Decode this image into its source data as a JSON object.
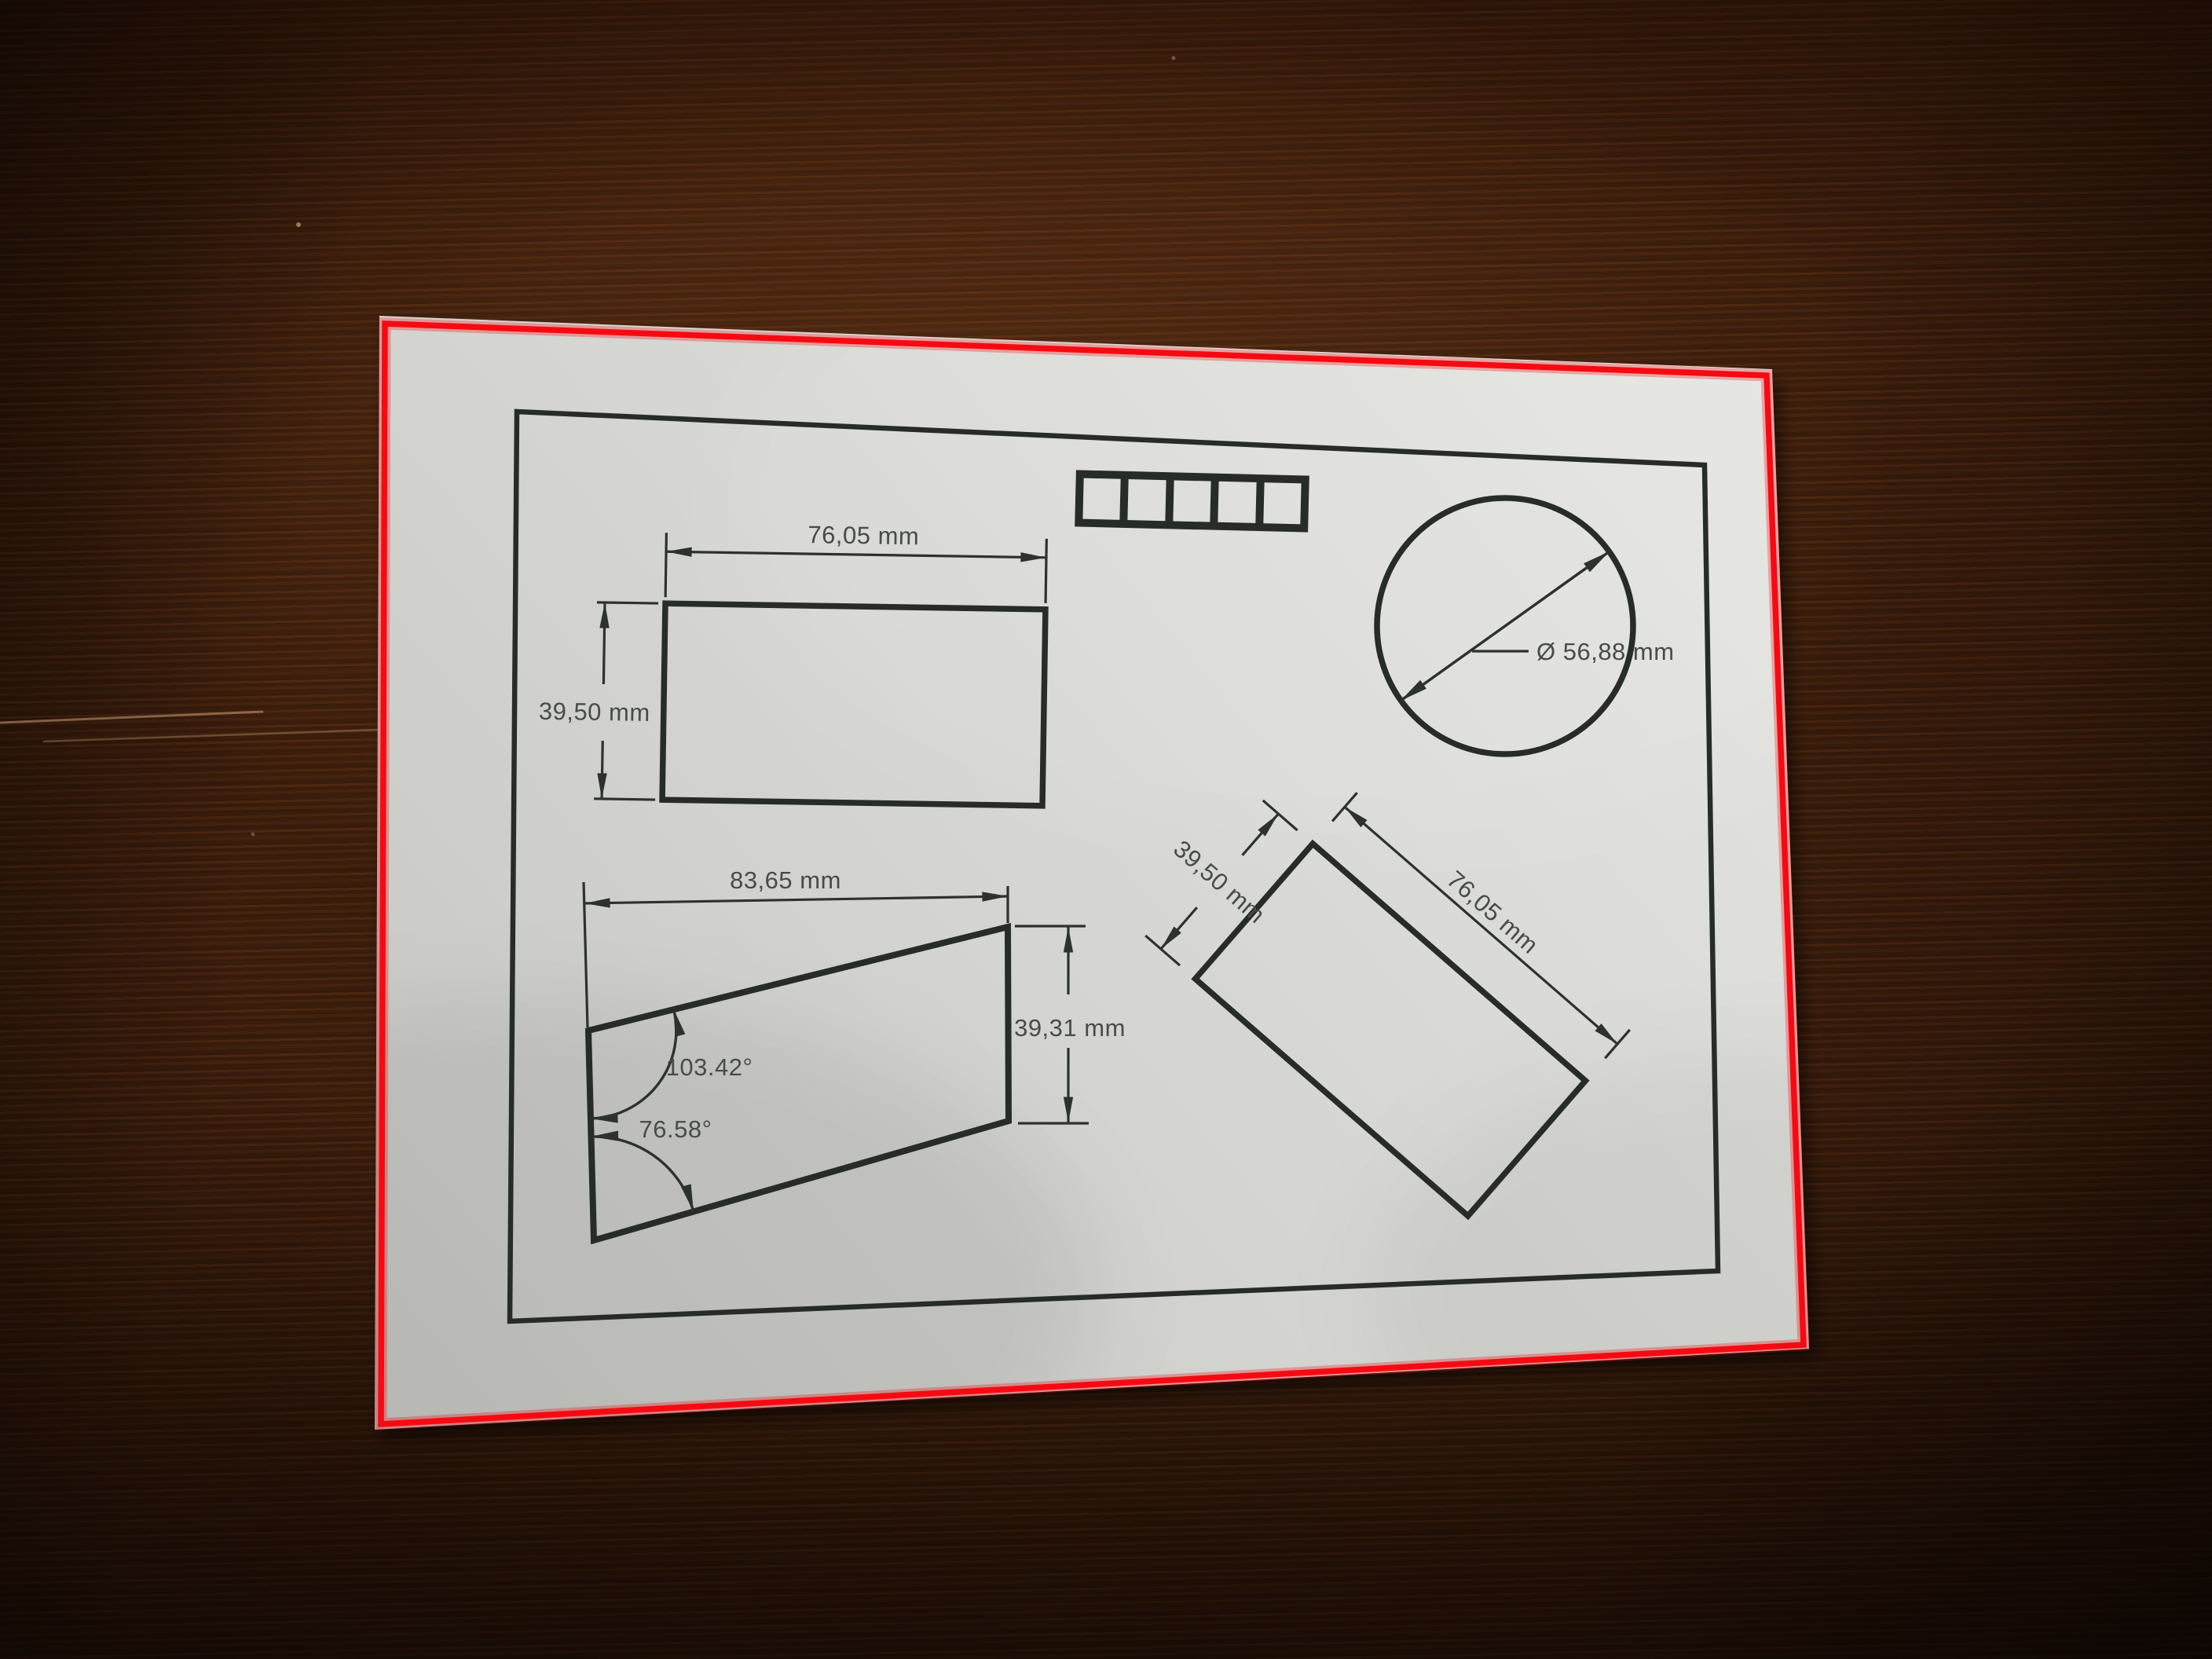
{
  "scene": {
    "description_labels": {},
    "calibration_strip": {
      "cells": 5
    },
    "figures": {
      "top_rect": {
        "width_label": "76,05 mm",
        "height_label": "39,50 mm"
      },
      "circle": {
        "diameter_label": "Ø 56,88 mm"
      },
      "tilted_rect": {
        "height_label": "39,50 mm",
        "width_label": "76,05 mm"
      },
      "trapezoid": {
        "width_label": "83,65 mm",
        "height_label": "39,31 mm",
        "top_angle_label": "103.42°",
        "bottom_angle_label": "76.58°"
      }
    },
    "colors": {
      "red_outline": "#f50a12",
      "paper": "#d6d6d2",
      "wood": "#3f1f0d",
      "ink": "#262c26",
      "label_text": "#474c47"
    }
  }
}
